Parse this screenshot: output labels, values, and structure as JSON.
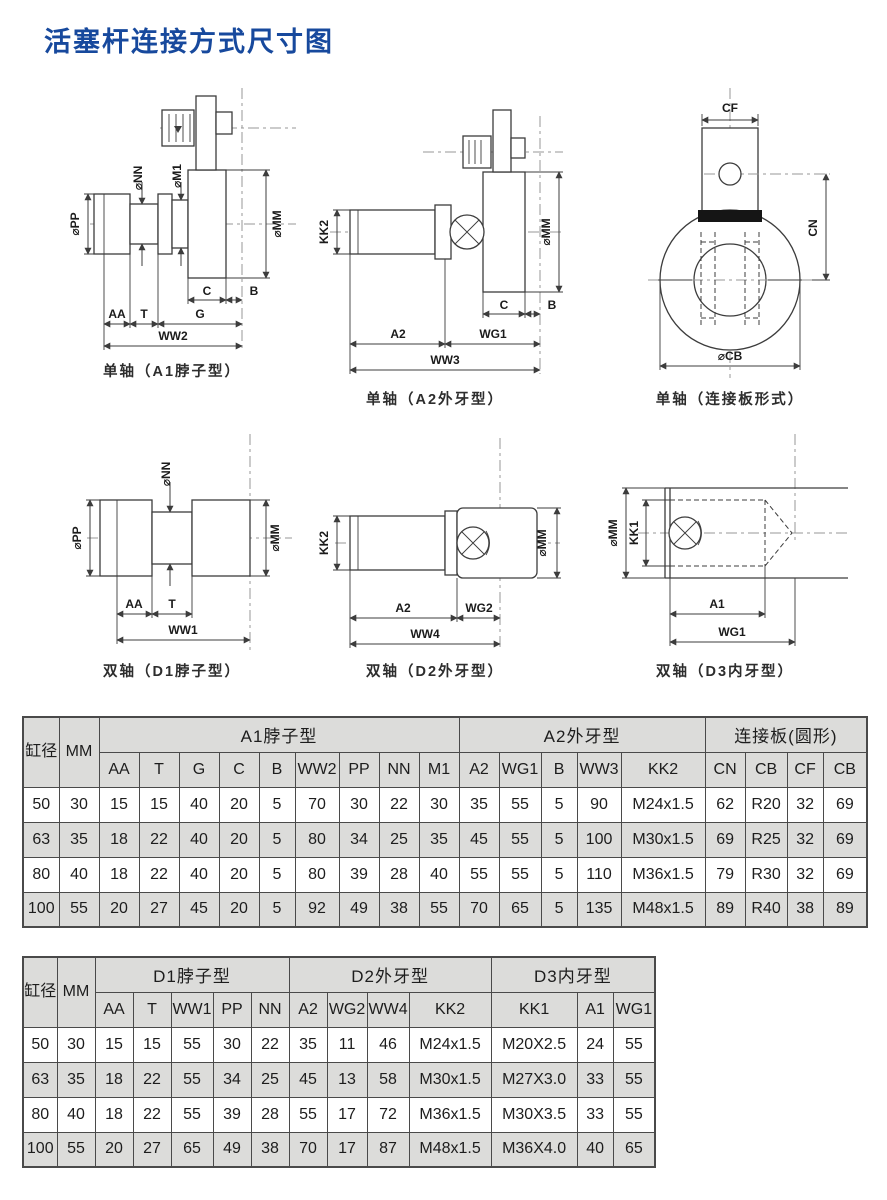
{
  "page": {
    "title": "活塞杆连接方式尺寸图"
  },
  "colors": {
    "title": "#17499d",
    "table_shade": "#dcdcda",
    "drawing_line": "#3c3c3c"
  },
  "diagrams": {
    "a1": {
      "caption": "单轴（A1脖子型）",
      "labels": {
        "pp": "⌀PP",
        "nn": "⌀NN",
        "m1": "⌀M1",
        "mm": "⌀MM",
        "c": "C",
        "b": "B",
        "aa": "AA",
        "t": "T",
        "g": "G",
        "ww2": "WW2"
      }
    },
    "a2": {
      "caption": "单轴（A2外牙型）",
      "labels": {
        "kk2": "KK2",
        "mm": "⌀MM",
        "c": "C",
        "b": "B",
        "a2": "A2",
        "wg1": "WG1",
        "ww3": "WW3"
      }
    },
    "cp": {
      "caption": "单轴（连接板形式）",
      "labels": {
        "cf": "CF",
        "cn": "CN",
        "cb": "⌀CB"
      }
    },
    "d1": {
      "caption": "双轴（D1脖子型）",
      "labels": {
        "pp": "⌀PP",
        "nn": "⌀NN",
        "mm": "⌀MM",
        "aa": "AA",
        "t": "T",
        "ww1": "WW1"
      }
    },
    "d2": {
      "caption": "双轴（D2外牙型）",
      "labels": {
        "kk2": "KK2",
        "mm": "⌀MM",
        "a2": "A2",
        "wg2": "WG2",
        "ww4": "WW4"
      }
    },
    "d3": {
      "caption": "双轴（D3内牙型）",
      "labels": {
        "mm": "⌀MM",
        "kk1": "KK1",
        "a1": "A1",
        "wg1": "WG1"
      }
    }
  },
  "table1": {
    "corner": "缸径",
    "mm": "MM",
    "groups": [
      {
        "label": "A1脖子型",
        "cols": [
          "AA",
          "T",
          "G",
          "C",
          "B",
          "WW2",
          "PP",
          "NN",
          "M1"
        ]
      },
      {
        "label": "A2外牙型",
        "cols": [
          "A2",
          "WG1",
          "B",
          "WW3",
          "KK2"
        ]
      },
      {
        "label": "连接板(圆形)",
        "cols": [
          "CN",
          "CB",
          "CF",
          "CB"
        ]
      }
    ],
    "rows": [
      [
        "50",
        "30",
        "15",
        "15",
        "40",
        "20",
        "5",
        "70",
        "30",
        "22",
        "30",
        "35",
        "55",
        "5",
        "90",
        "M24x1.5",
        "62",
        "R20",
        "32",
        "69"
      ],
      [
        "63",
        "35",
        "18",
        "22",
        "40",
        "20",
        "5",
        "80",
        "34",
        "25",
        "35",
        "45",
        "55",
        "5",
        "100",
        "M30x1.5",
        "69",
        "R25",
        "32",
        "69"
      ],
      [
        "80",
        "40",
        "18",
        "22",
        "40",
        "20",
        "5",
        "80",
        "39",
        "28",
        "40",
        "55",
        "55",
        "5",
        "110",
        "M36x1.5",
        "79",
        "R30",
        "32",
        "69"
      ],
      [
        "100",
        "55",
        "20",
        "27",
        "45",
        "20",
        "5",
        "92",
        "49",
        "38",
        "55",
        "70",
        "65",
        "5",
        "135",
        "M48x1.5",
        "89",
        "R40",
        "38",
        "89"
      ]
    ]
  },
  "table2": {
    "corner": "缸径",
    "mm": "MM",
    "groups": [
      {
        "label": "D1脖子型",
        "cols": [
          "AA",
          "T",
          "WW1",
          "PP",
          "NN"
        ]
      },
      {
        "label": "D2外牙型",
        "cols": [
          "A2",
          "WG2",
          "WW4",
          "KK2"
        ]
      },
      {
        "label": "D3内牙型",
        "cols": [
          "KK1",
          "A1",
          "WG1"
        ]
      }
    ],
    "rows": [
      [
        "50",
        "30",
        "15",
        "15",
        "55",
        "30",
        "22",
        "35",
        "11",
        "46",
        "M24x1.5",
        "M20X2.5",
        "24",
        "55"
      ],
      [
        "63",
        "35",
        "18",
        "22",
        "55",
        "34",
        "25",
        "45",
        "13",
        "58",
        "M30x1.5",
        "M27X3.0",
        "33",
        "55"
      ],
      [
        "80",
        "40",
        "18",
        "22",
        "55",
        "39",
        "28",
        "55",
        "17",
        "72",
        "M36x1.5",
        "M30X3.5",
        "33",
        "55"
      ],
      [
        "100",
        "55",
        "20",
        "27",
        "65",
        "49",
        "38",
        "70",
        "17",
        "87",
        "M48x1.5",
        "M36X4.0",
        "40",
        "65"
      ]
    ]
  }
}
